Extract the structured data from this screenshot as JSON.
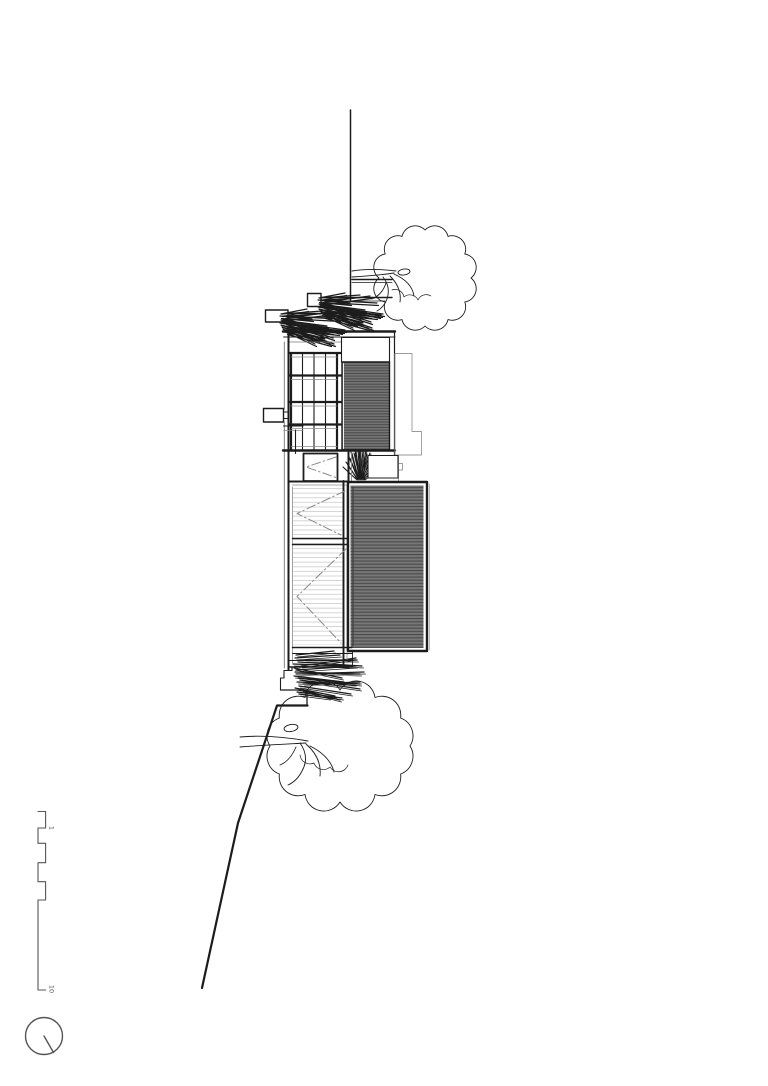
{
  "drawing": {
    "scale_bar": {
      "label_start": "1",
      "label_end": "10"
    },
    "colors": {
      "background": "#ffffff",
      "line": "#1c1c1c",
      "medium_line": "#555555",
      "light_line": "#999999",
      "faint_line": "#cccccc",
      "dashdot_line": "#8a8a8a",
      "louver_fill": "#767676",
      "louver_stripe": "#474747"
    }
  }
}
